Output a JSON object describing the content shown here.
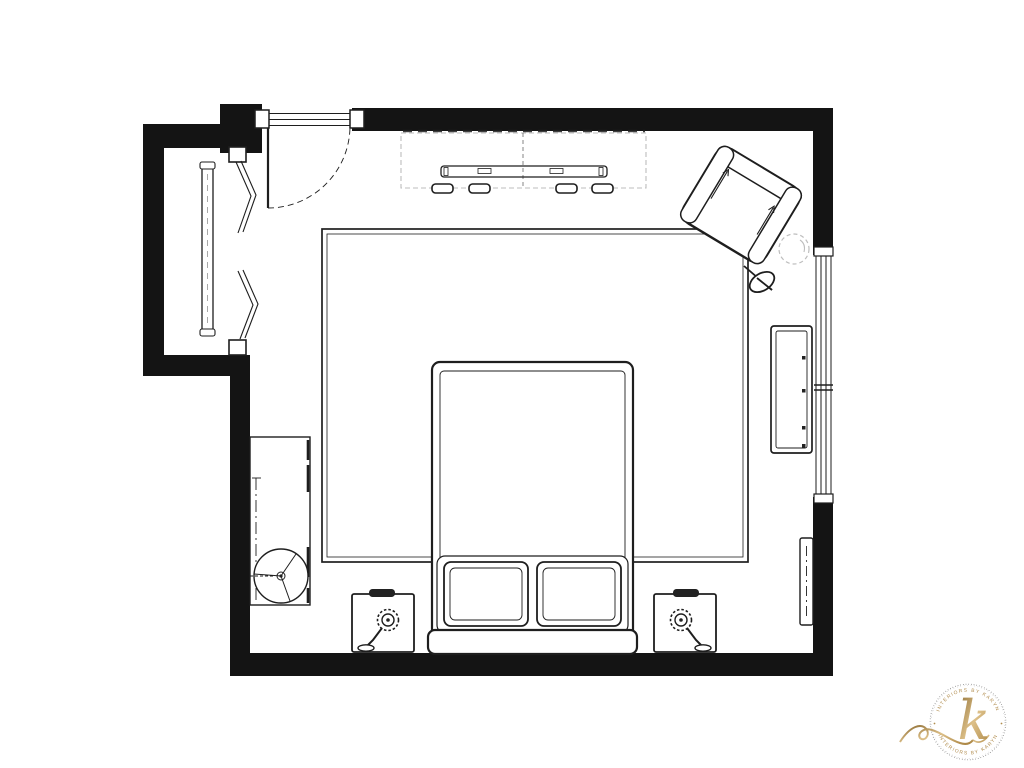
{
  "colors": {
    "wall": "#141414",
    "line": "#1e1e1e",
    "faint": "#bdbdbd",
    "gold": "#b18c4d",
    "gold_dark": "#8c6b31",
    "gold_light": "#ddc089",
    "ring_gray": "#6f6f6f",
    "background": "#ffffff"
  },
  "logo": {
    "monogram": "k",
    "arc_text_top": "INTERIORS BY KARYN",
    "arc_text_bottom": "INTERIORS BY KARYN"
  },
  "floor_plan": {
    "room": "bedroom",
    "furniture": [
      "entry door with swing arc",
      "closet with bifold doors and hanging rod",
      "dresser (dashed) with knobs",
      "armchair (angled in corner)",
      "round side table (dashed)",
      "floor lamp",
      "window bench console",
      "area rug",
      "queen bed with two pillows and headboard",
      "left nightstand with lamp",
      "right nightstand with lamp",
      "desk with round stool",
      "leaning mirror",
      "ceiling light fixture (dashed)",
      "right wall window"
    ]
  }
}
